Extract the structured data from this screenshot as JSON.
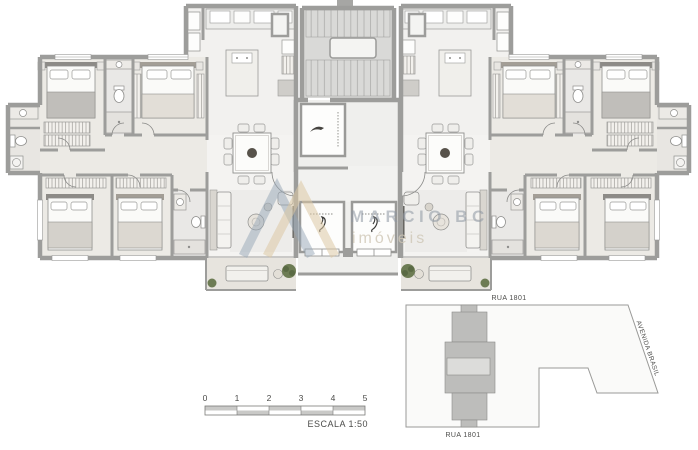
{
  "watermark": {
    "brand": "MARCIO BC",
    "subtitle": "imóveis"
  },
  "scale_bar": {
    "ticks": [
      "0",
      "1",
      "2",
      "3",
      "4",
      "5"
    ],
    "label": "ESCALA 1:50"
  },
  "site_map": {
    "street_top": "RUA 1801",
    "street_bottom": "RUA 1801",
    "street_side": "AVENIDA BRASIL"
  },
  "colors": {
    "wall": "#9d9d9b",
    "floor": "#f2f1ef",
    "bedroom_floor": "#e9e6e1",
    "balcony_floor": "#e7e4de",
    "stair_floor": "#dadad8",
    "plant_green": "#6d7c54",
    "watermark_blue": "#96a5b6",
    "watermark_beige": "#dcc9a4",
    "lot_fill": "#fafaf9",
    "footprint_gray": "#bdbdbb",
    "text_gray": "#4c4c4a"
  }
}
